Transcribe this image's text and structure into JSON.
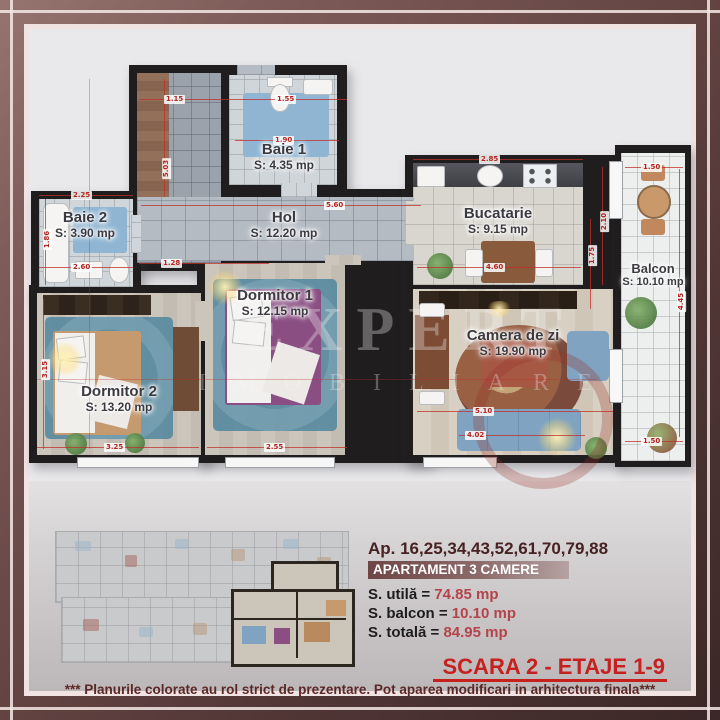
{
  "plan": {
    "watermark": {
      "line1": "EXPERT",
      "line2": "IMOBILIARE"
    },
    "rooms": {
      "baie1": {
        "name": "Baie 1",
        "area": "S: 4.35 mp"
      },
      "baie2": {
        "name": "Baie 2",
        "area": "S: 3.90 mp"
      },
      "hol": {
        "name": "Hol",
        "area": "S: 12.20 mp"
      },
      "bucatarie": {
        "name": "Bucatarie",
        "area": "S: 9.15 mp"
      },
      "dormitor1": {
        "name": "Dormitor 1",
        "area": "S: 12.15 mp"
      },
      "dormitor2": {
        "name": "Dormitor 2",
        "area": "S: 13.20 mp"
      },
      "camera_de_zi": {
        "name": "Camera de zi",
        "area": "S: 19.90 mp"
      },
      "balcon": {
        "name": "Balcon",
        "area": "S: 10.10 mp"
      }
    },
    "dimensions": [
      "1.15",
      "1.55",
      "1.90",
      "5.60",
      "2.25",
      "2.60",
      "1.28",
      "2.85",
      "4.60",
      "2.55",
      "3.25",
      "5.10",
      "4.02",
      "1.50",
      "4.45",
      "2.10",
      "1.75",
      "3.15",
      "5.03",
      "1.86",
      "1.50"
    ]
  },
  "info": {
    "apartments_line": "Ap. 16,25,34,43,52,61,70,79,88",
    "type_label": "APARTAMENT 3 CAMERE",
    "areas": [
      {
        "label": "S. utilă =",
        "value": "74.85 mp"
      },
      {
        "label": "S. balcon =",
        "value": "10.10 mp"
      },
      {
        "label": "S. totală =",
        "value": "84.95 mp"
      }
    ],
    "scara": "SCARA 2 - ETAJE 1-9",
    "disclaimer": "*** Planurile colorate au rol strict de prezentare. Pot aparea modificari in arhitectura finala***"
  },
  "colors": {
    "accent_red": "#c6201f",
    "dim_red": "#c2332e",
    "value_red": "#b5434b",
    "frame_maroon": "#533737"
  }
}
